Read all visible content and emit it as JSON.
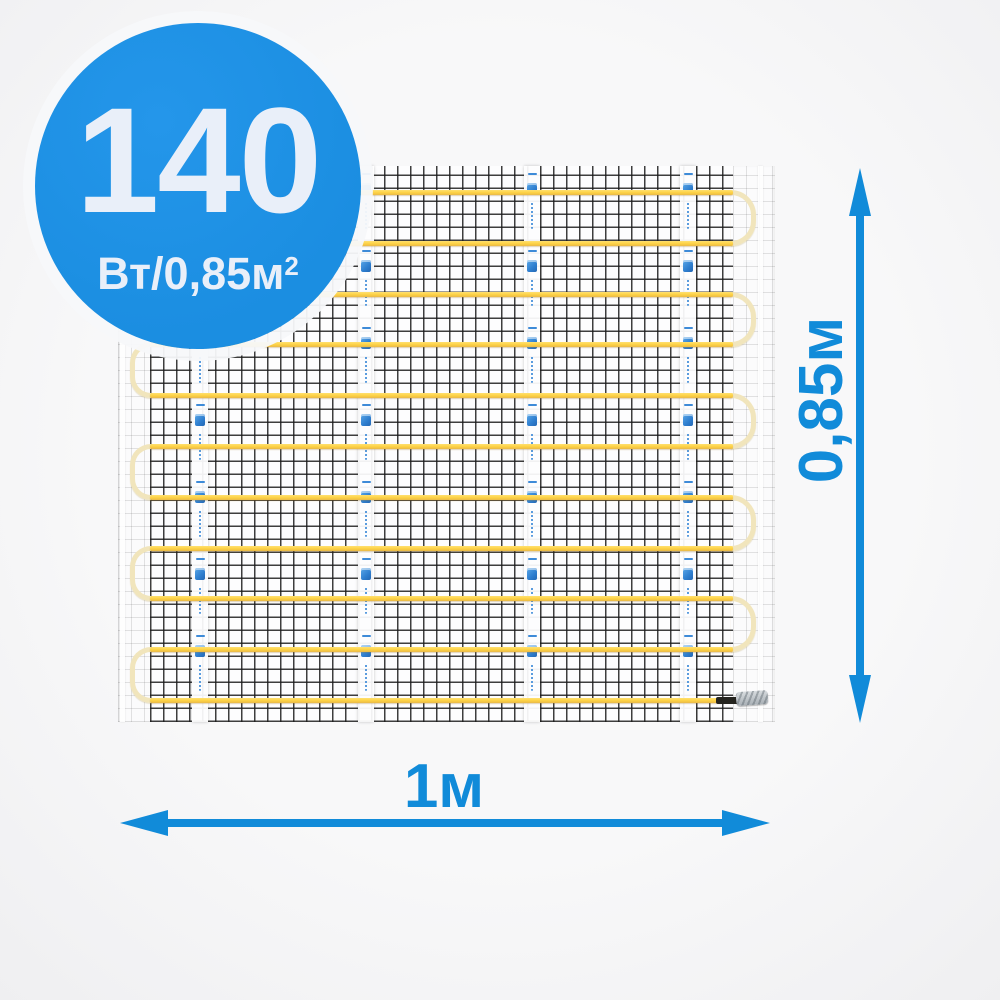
{
  "badge": {
    "value": "140",
    "unit_base": "Вт/0,85м",
    "unit_sup": "2"
  },
  "dimensions": {
    "width_label": "1м",
    "height_label": "0,85м"
  },
  "mat": {
    "cable_rows": 11,
    "tape_strips": 4,
    "tape_segments": 7,
    "logo_icon": "brand-logo",
    "end_connector": "cable-end-sleeve"
  },
  "colors": {
    "accent_blue": "#118bd9",
    "badge_blue": "#1b8ee1",
    "badge_text": "#e9eff9",
    "cable_yellow": "#ffd23f",
    "loop_cream": "#f1e5bc",
    "mesh_black": "#1c1c1c",
    "background": "#f7f7f8"
  }
}
